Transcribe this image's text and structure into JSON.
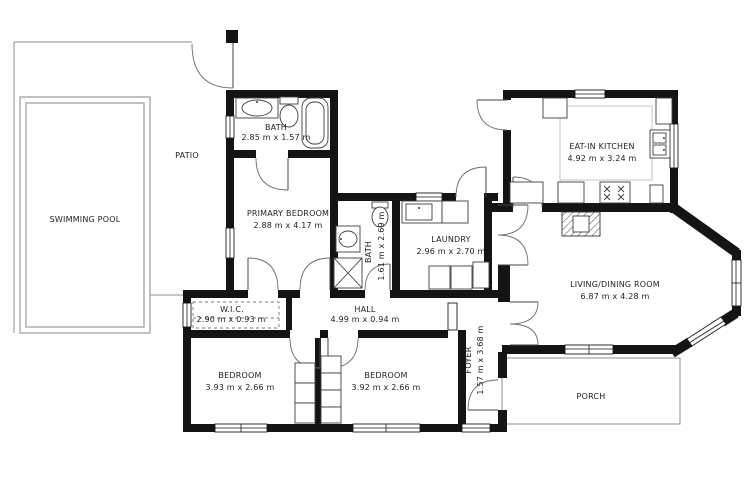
{
  "rooms": {
    "patio": {
      "name": "PATIO"
    },
    "pool": {
      "name": "SWIMMING POOL"
    },
    "bath_top": {
      "name": "BATH",
      "dims": "2.85 m x 1.57 m"
    },
    "primary": {
      "name": "PRIMARY BEDROOM",
      "dims": "2.88 m x 4.17 m"
    },
    "bath_mid": {
      "name": "BATH",
      "dims": "1.61 m x 2.69 m"
    },
    "laundry": {
      "name": "LAUNDRY",
      "dims": "2.96 m x 2.70 m"
    },
    "kitchen": {
      "name": "EAT-IN KITCHEN",
      "dims": "4.92 m x 3.24 m"
    },
    "living": {
      "name": "LIVING/DINING ROOM",
      "dims": "6.87 m x 4.28 m"
    },
    "wic": {
      "name": "W.I.C.",
      "dims": "2.90 m x 0.93 m"
    },
    "hall": {
      "name": "HALL",
      "dims": "4.99 m x 0.94 m"
    },
    "bedroom_left": {
      "name": "BEDROOM",
      "dims": "3.93 m x 2.66 m"
    },
    "bedroom_right": {
      "name": "BEDROOM",
      "dims": "3.92 m x 2.66 m"
    },
    "foyer": {
      "name": "FOYER",
      "dims": "1.57 m x 3.68 m"
    },
    "porch": {
      "name": "PORCH"
    }
  },
  "colors": {
    "wall": "#141414",
    "background": "#ffffff",
    "text": "#1d1d1d",
    "thin_line": "#8f8f8f"
  }
}
